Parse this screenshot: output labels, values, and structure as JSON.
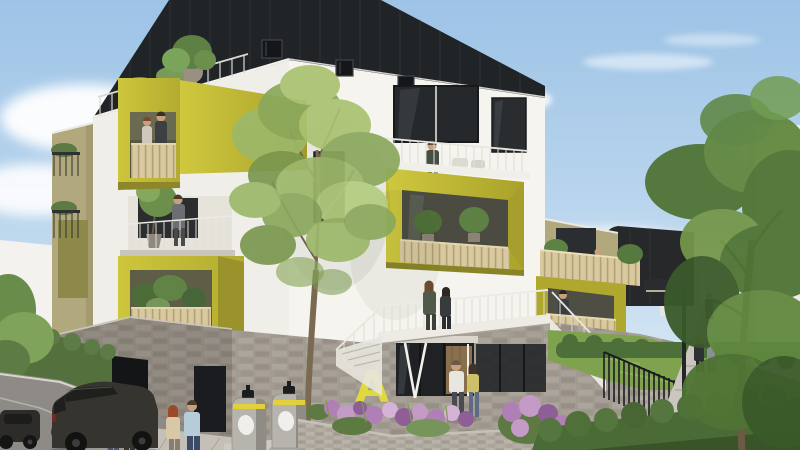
{
  "scene": {
    "type": "architectural-rendering",
    "setting": "contemporary apartment residence on a sunny day, street-level view with landscaped garden",
    "entrance_letter": "A"
  },
  "colors": {
    "sky_top": "#9dc3e6",
    "sky_horizon": "#e9f2f9",
    "cladding": "#212427",
    "facade_front": "#f6f4ee",
    "facade_left": "#efeee8",
    "chartreuse": "#c0b833",
    "chartreuse_bright": "#dfd93e",
    "chartreuse_shade": "#a69f2d",
    "soffit_olive": "#8a8428",
    "wood_slat": "#d9c99f",
    "beige_wing": "#b2a87e",
    "olive_panel": "#8d894b",
    "stone": "#a29b91",
    "stone_shadow": "#8f8a82",
    "glass": "#26292c",
    "garage_dark": "#141517",
    "bin_grey": "#b7b4ae",
    "bin_stripe": "#e3d13c",
    "lawn": "#7fa24f",
    "hedge": "#4d6f3a",
    "foliage_light": "#9cb86a",
    "foliage_dark": "#4f7434",
    "bloom_purple": "#b07fb5",
    "street": "#8e8b86",
    "pavement": "#c4c0b8",
    "car_dark": "#36342f",
    "lamp_black": "#232527",
    "skin": "#c9a07f"
  },
  "elements": {
    "building": {
      "attic": "black standing-seam zinc top floor with small windows, parapet sloping right",
      "facade": "white rendered walls",
      "balconies": "chartreuse box balconies with timber slat balustrades and planted pots",
      "roof_terrace": "railing with planters and shrubs",
      "side_wing": "beige wall with olive panel and small dark balconies",
      "base": "grey stone masonry plinth with garage and service door",
      "entrance": "glass doors with timber panel, white V-strut, chartreuse letter A on stone"
    },
    "people": [
      "couple on upper chartreuse balcony",
      "man beside potted tree on mid balcony",
      "woman on central terrace",
      "woman on right chartreuse balcony",
      "two women on entrance walkway",
      "figure on beige side terrace",
      "man in white shirt and woman in yellow top walking to entrance",
      "red-haired woman and man in light-blue shirt on sidewalk",
      "two pedestrians standing by the street",
      "cyclist",
      "two walkers and a distant figure on the garden path"
    ],
    "vehicles": [
      "dark SUV entering the garage",
      "dark parked car at far left",
      "dark car roof behind hedge bottom right",
      "bicycle"
    ],
    "street_furniture": [
      "two grey waste bins with yellow stripe",
      "black lamp post",
      "black vertical-bar fence on stone wall",
      "white guard railings and stairs"
    ],
    "landscape": [
      "young airy tree in flower bed",
      "purple and pink flower beds",
      "trimmed hedges",
      "sloped lawn with garden path",
      "large leafy trees at right",
      "distant white buildings"
    ]
  }
}
